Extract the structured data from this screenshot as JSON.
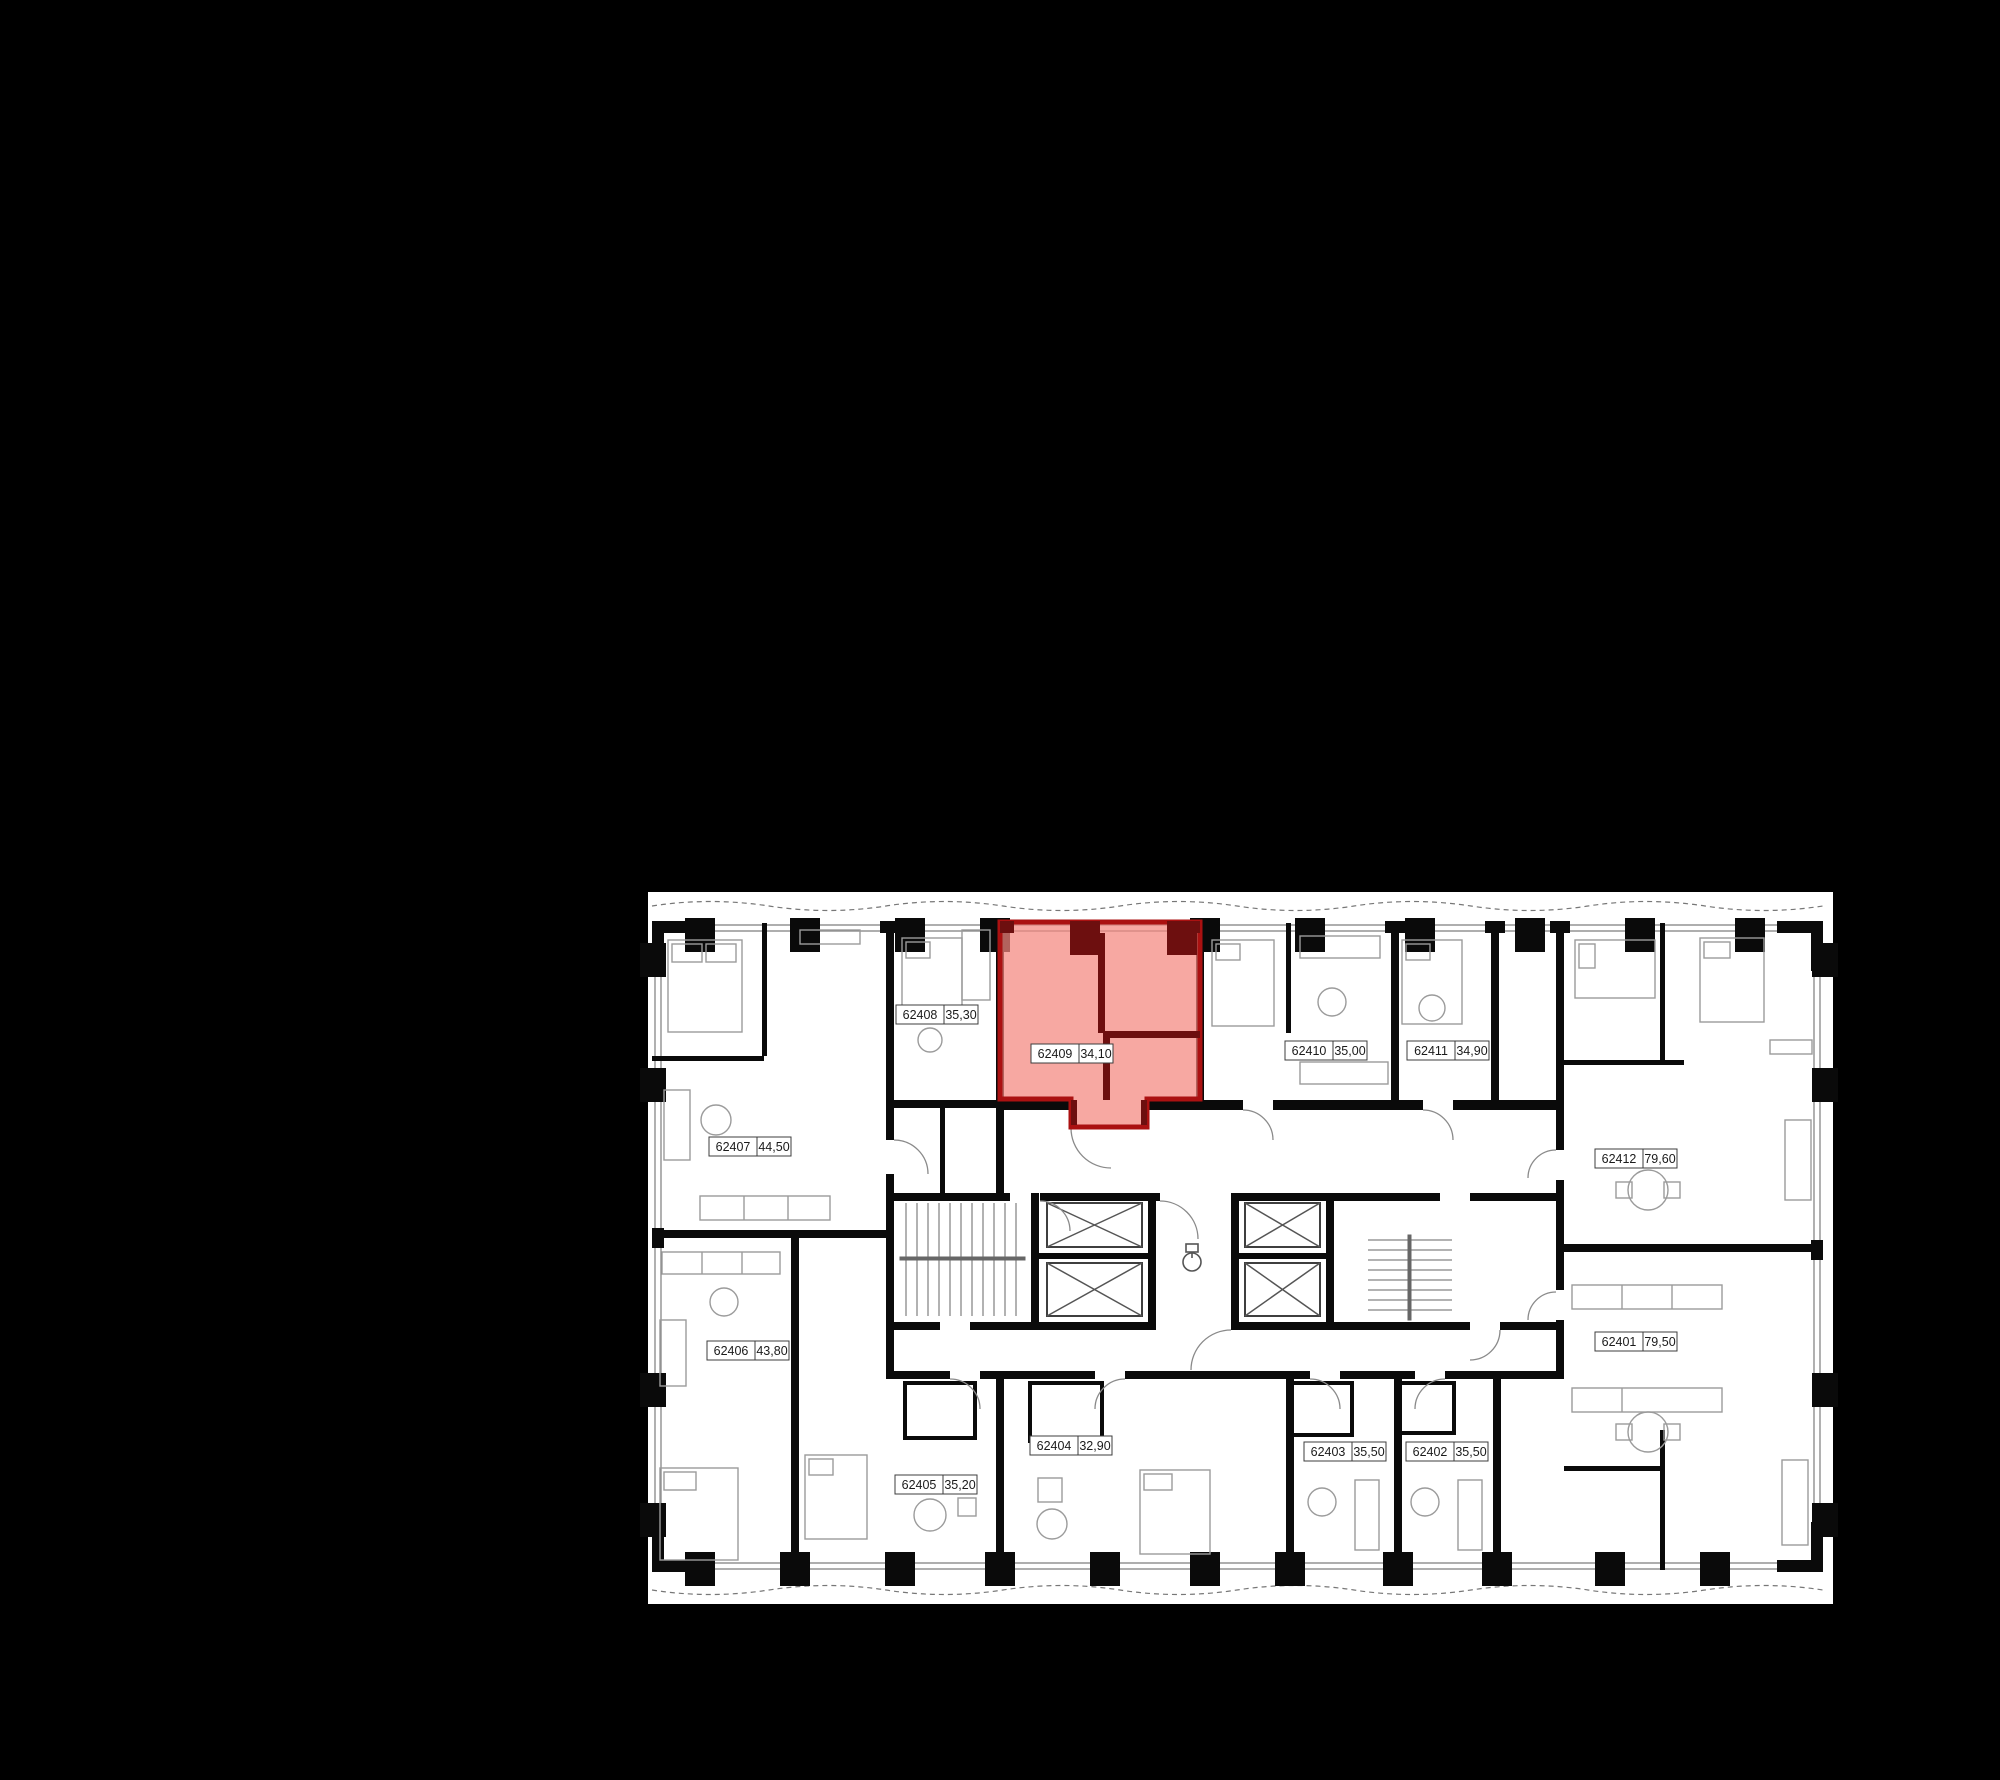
{
  "app": {
    "type": "apartment-floorplan-selector",
    "background_color": "#000000",
    "paper_color": "#ffffff",
    "wall_color": "#0a0a0a",
    "thin_line_color": "#8a8a8a"
  },
  "floorplan": {
    "highlight": {
      "unit_id": "62409",
      "area": "34,10",
      "fill": "#f4867e",
      "fill_hex_overlay": "#ee594e",
      "border": "#ab1111",
      "wall_accent": "#6d0f0f"
    },
    "units": [
      {
        "id": "62408",
        "area": "35,30",
        "highlighted": false
      },
      {
        "id": "62409",
        "area": "34,10",
        "highlighted": true
      },
      {
        "id": "62410",
        "area": "35,00",
        "highlighted": false
      },
      {
        "id": "62411",
        "area": "34,90",
        "highlighted": false
      },
      {
        "id": "62412",
        "area": "79,60",
        "highlighted": false
      },
      {
        "id": "62401",
        "area": "79,50",
        "highlighted": false
      },
      {
        "id": "62402",
        "area": "35,50",
        "highlighted": false
      },
      {
        "id": "62403",
        "area": "35,50",
        "highlighted": false
      },
      {
        "id": "62404",
        "area": "32,90",
        "highlighted": false
      },
      {
        "id": "62405",
        "area": "35,20",
        "highlighted": false
      },
      {
        "id": "62406",
        "area": "43,80",
        "highlighted": false
      },
      {
        "id": "62407",
        "area": "44,50",
        "highlighted": false
      }
    ]
  }
}
